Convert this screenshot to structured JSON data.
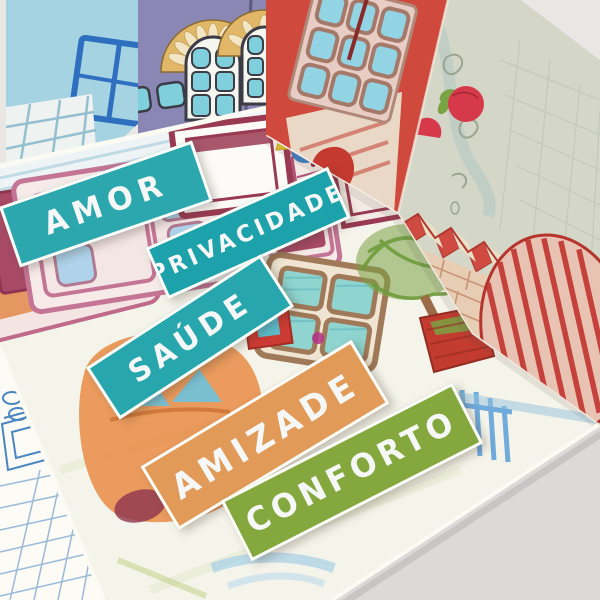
{
  "labels": [
    {
      "id": "amor",
      "text": "AMOR",
      "bg": "#2ba7ad"
    },
    {
      "id": "privacidade",
      "text": "PRIVACIDADE",
      "bg": "#1da2ab"
    },
    {
      "id": "saude",
      "text": "SAÚDE",
      "bg": "#27a6ad"
    },
    {
      "id": "amizade",
      "text": "AMIZADE",
      "bg": "#e19a57"
    },
    {
      "id": "conforto",
      "text": "CONFORTO",
      "bg": "#84a83e"
    }
  ],
  "palette": {
    "table": "#e9e7e4",
    "table_shade": "#dcdad8",
    "card_blue": "#a6d3e2",
    "card_purple": "#8a87b4",
    "arch_gold": "#e2b868",
    "arch_petal": "#f3e6c4",
    "window_pane": "#7fcfdd",
    "window_frame": "#f6f6f0",
    "house_red": "#cf4a3c",
    "panel_sage": "#d4d7c8",
    "strawberry_red": "#d6394a",
    "leaf_green": "#7aa344",
    "sheet_cream": "#f5f4ea",
    "wall_stripe_blue": "#b9d6e3",
    "furniture_pink": "#c47596",
    "furniture_maroon": "#9a3a52",
    "car_orange": "#e89350",
    "tree_green": "#79a344",
    "pot_red": "#c23b2f",
    "pen_blue": "#4a86c0",
    "stair_red": "#cf4a40",
    "brick_tan": "#e6cdb4"
  }
}
